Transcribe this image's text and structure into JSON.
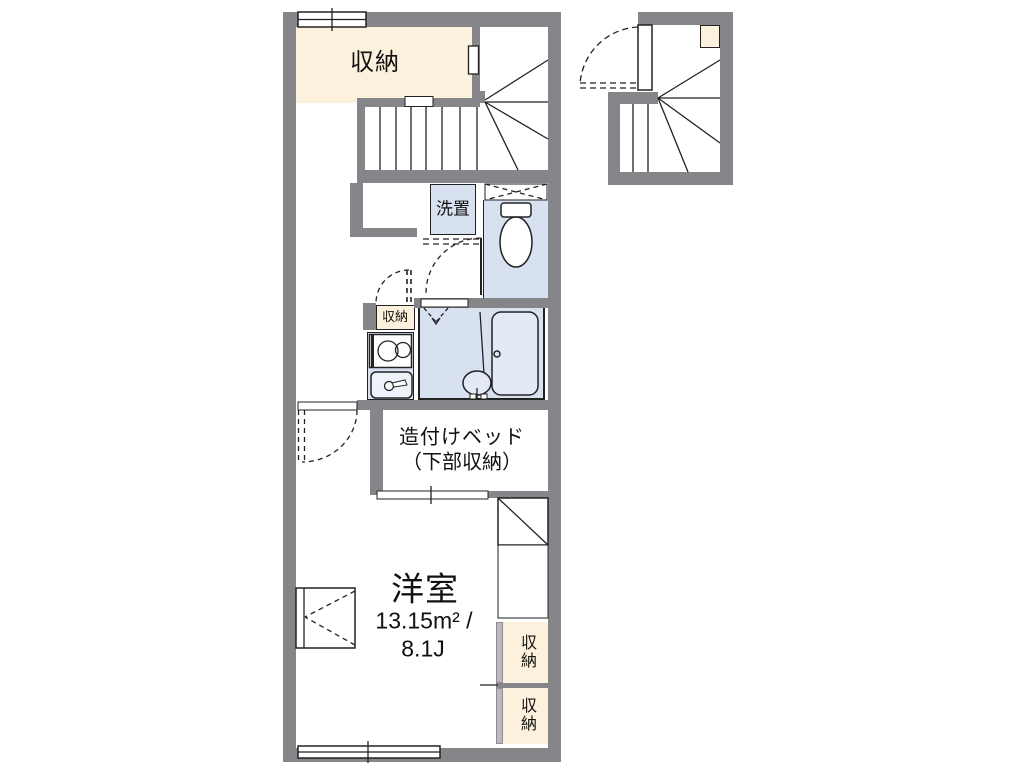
{
  "plan": {
    "title_hint": "apartment-floor-plan",
    "rooms": {
      "storage_top": "収納",
      "washer": "洗置",
      "hall_storage": "収納",
      "bed_line1": "造付けベッド",
      "bed_line2": "（下部収納）",
      "main_name": "洋室",
      "main_area_sqm": "13.15m² /",
      "main_area_tatami": "8.1J",
      "closet_upper": "収納",
      "closet_lower": "収納"
    },
    "colors": {
      "wall_gray": "#85858a",
      "storage_cream": "#fbf1dc",
      "fixture_blue": "#d8e1f0",
      "line": "#222222",
      "background": "#ffffff"
    }
  }
}
